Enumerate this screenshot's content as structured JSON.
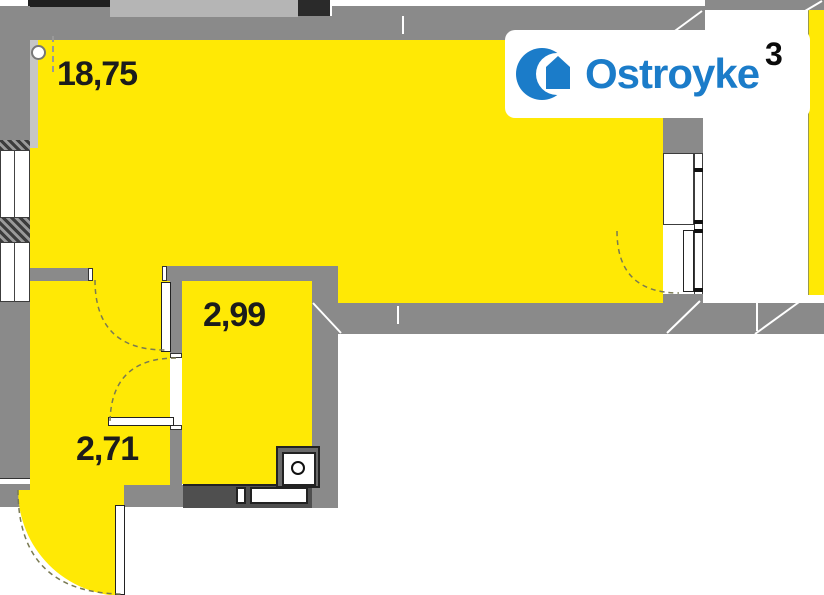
{
  "plan_title": "apartment-floor-plan",
  "rooms": [
    {
      "name": "living-room",
      "area_label": "18,75"
    },
    {
      "name": "inner-room",
      "area_label": "2,99"
    },
    {
      "name": "hallway",
      "area_label": "2,71"
    }
  ],
  "logo": {
    "text": "Ostroyke",
    "superscript": "3",
    "icon": "building-crescent-icon"
  },
  "colors": {
    "room-fill": "#FFE905",
    "wall": "#8A8A8A",
    "wall-dark": "#4F4F4F",
    "wall-light": "#B5B5B5",
    "wall-black": "#1F1F1F",
    "logo-blue": "#1B7CC9",
    "label": "#1C1C1C",
    "arc": "#7A7A52"
  }
}
